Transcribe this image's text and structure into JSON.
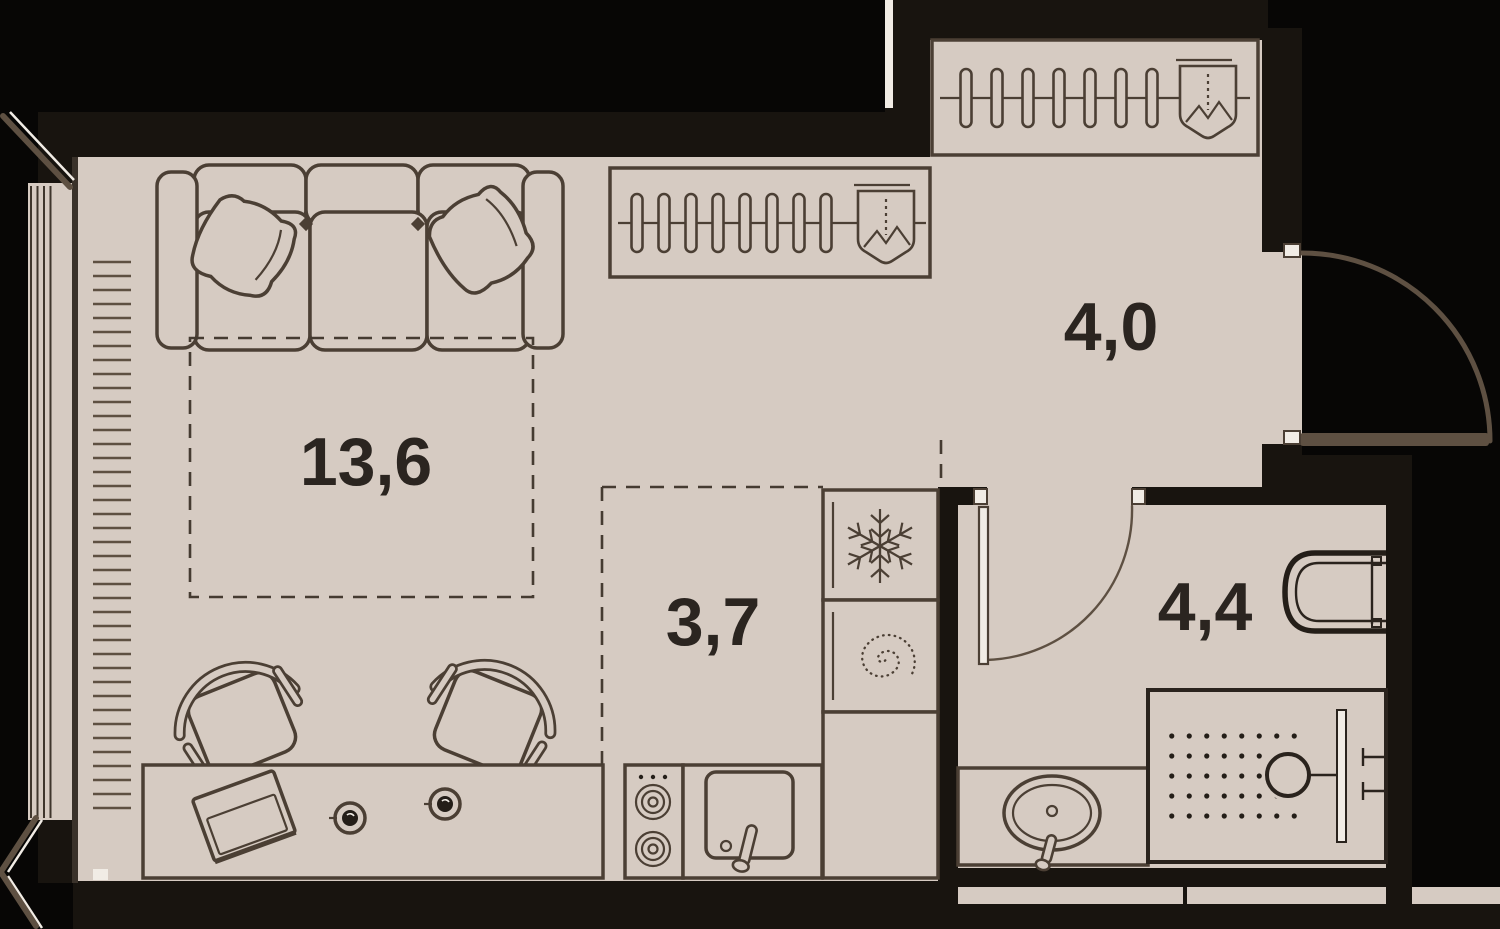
{
  "plan": {
    "type": "apartment-floor-plan",
    "layout": "studio",
    "rooms": [
      {
        "name": "living-room",
        "area": "13,6"
      },
      {
        "name": "hallway",
        "area": "4,0"
      },
      {
        "name": "kitchen",
        "area": "3,7"
      },
      {
        "name": "bathroom",
        "area": "4,4"
      }
    ],
    "colors": {
      "background": "#070605",
      "wall": "#18140f",
      "floor": "#d6cbc2",
      "furniture_line": "#4b3f34",
      "fixture_line": "#241e18",
      "door": "#5e5042",
      "label": "#2b2520",
      "highlight": "#f1ece5"
    },
    "icons": {
      "snowflake-icon": "refrigerator",
      "spiral-icon": "washing-machine",
      "hanger-icon": "wardrobe-hanger",
      "vacuum-cleaner-icon": "vacuum-cleaner-storage",
      "burner-icon": "stove-burner",
      "shower-head-icon": "shower-drain",
      "laptop-icon": "laptop",
      "cup-icon": "cup"
    }
  }
}
